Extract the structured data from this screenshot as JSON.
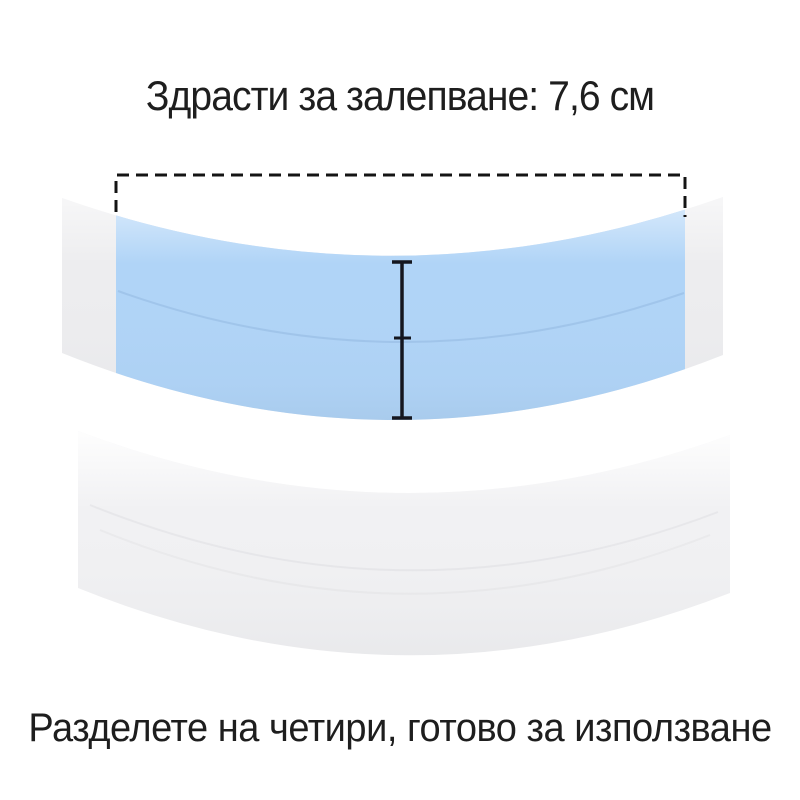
{
  "page": {
    "background": "#ffffff",
    "text_color": "#1e1e1e"
  },
  "header": {
    "title": "Здрасти за залепване: 7,6 см"
  },
  "footer": {
    "caption": "Разделете на четири, готово за използване"
  },
  "measurement": {
    "width_value": "7,6 см",
    "dash_color": "#141414",
    "height_line_color": "#14161f"
  },
  "product": {
    "top_tape": {
      "kind": "blue adhesive contour tape strip",
      "adhesive_color": "#b0d4f7",
      "end_cap_color": "#ededef",
      "seam_color": "#86aed8"
    },
    "bottom_tape": {
      "kind": "white tape strip",
      "color": "#f1f1f3",
      "crease_color": "#dcdcdf"
    }
  }
}
